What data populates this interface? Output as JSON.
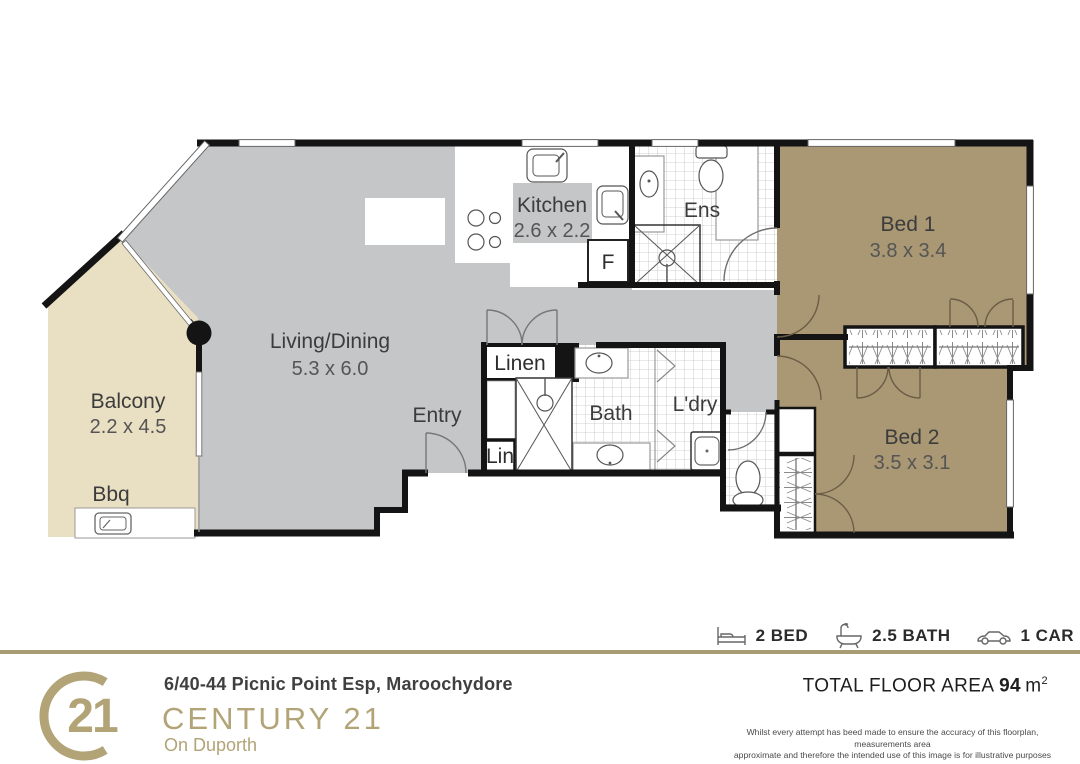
{
  "plan": {
    "living": {
      "name": "Living/Dining",
      "dims": "5.3 x 6.0"
    },
    "kitchen": {
      "name": "Kitchen",
      "dims": "2.6 x 2.2"
    },
    "ens": {
      "name": "Ens"
    },
    "bed1": {
      "name": "Bed 1",
      "dims": "3.8 x 3.4"
    },
    "bed2": {
      "name": "Bed 2",
      "dims": "3.5 x 3.1"
    },
    "bath": {
      "name": "Bath"
    },
    "laundry": {
      "name": "L'dry"
    },
    "linen": {
      "name": "Linen"
    },
    "lin": {
      "name": "Lin"
    },
    "entry": {
      "name": "Entry"
    },
    "balcony": {
      "name": "Balcony",
      "dims": "2.2 x 4.5"
    },
    "bbq": {
      "name": "Bbq"
    },
    "fridge": {
      "name": "F"
    }
  },
  "footer": {
    "logo_number": "21",
    "address": "6/40-44 Picnic Point Esp, Maroochydore",
    "brand": "CENTURY 21",
    "office": "On Duporth",
    "features": [
      {
        "icon": "bed-icon",
        "label": "2 BED"
      },
      {
        "icon": "bath-icon",
        "label": "2.5 BATH"
      },
      {
        "icon": "car-icon",
        "label": "1 CAR"
      }
    ],
    "total_area_label": "TOTAL FLOOR AREA ",
    "total_area_value": "94",
    "total_area_unit": "m",
    "total_area_sup": "2",
    "disclaimer": [
      "Whilst every attempt has beed made to ensure the accuracy of this floorplan, measurements area",
      "approximate and therefore the intended use of this image is for illustrative purposes only and is",
      "subject to strict copyright. For more information please contact Corner Design Studio."
    ]
  },
  "colors": {
    "brand_gold": "#b2a477",
    "floor_gray": "#c5c6c8",
    "balcony_beige": "#e9dfc2",
    "bedroom_tan": "#a99873",
    "wall_black": "#141414"
  }
}
